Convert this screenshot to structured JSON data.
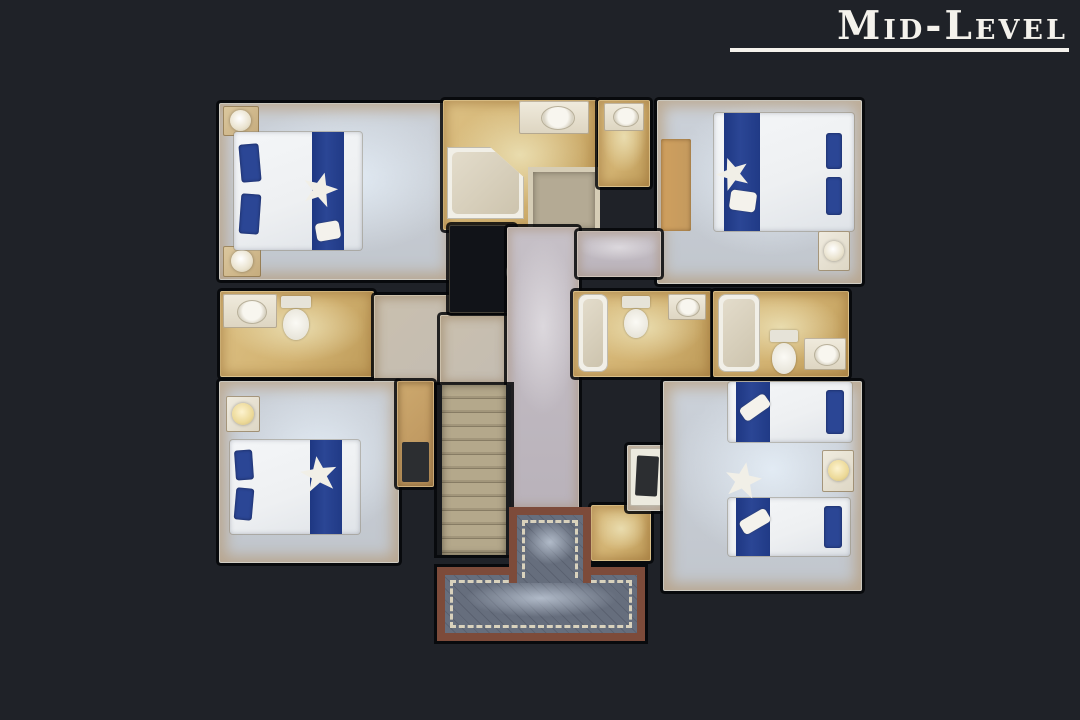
{
  "header": {
    "floor_label": "Mid-Level"
  },
  "scene": {
    "type": "3d-dollhouse-floorplan-top-view",
    "visible_rooms": [
      "bedroom-top-left",
      "master-bathroom",
      "water-closet",
      "bedroom-top-right",
      "bathroom-left",
      "landing",
      "stairwell-opening",
      "hallway",
      "bathroom-center",
      "bathroom-right",
      "bedroom-bottom-left",
      "closet-nook",
      "staircase",
      "tiled-foyer",
      "closet-room",
      "bedroom-bottom-right"
    ],
    "furnishings": [
      "double-bed-white-with-blue-runner",
      "starfish-decor",
      "nightstand-with-lamp",
      "bathtub",
      "shower",
      "toilet",
      "vanity-sink",
      "dresser",
      "twin-beds"
    ]
  },
  "palette": {
    "bg": "#1f2228",
    "title": "#f4f2ec",
    "carpet": "#cbd1d9",
    "carpetHaze": "#e2ebf4",
    "bathFloor": "#d2b271",
    "bathLight": "#e9dcae",
    "hallFloor": "#c6c0c7",
    "bedWhite": "#eef0f2",
    "bedBlue": "#2b4695",
    "fixture": "#f1efe7",
    "tileBorder": "#7d4b3a",
    "tileField": "#646c7b",
    "tileAccent": "#e6ddc4",
    "stairTread": "#b4a88b",
    "wood": "#c49a5e",
    "darkObject": "#2c2e31",
    "voidFill": "#111318"
  }
}
